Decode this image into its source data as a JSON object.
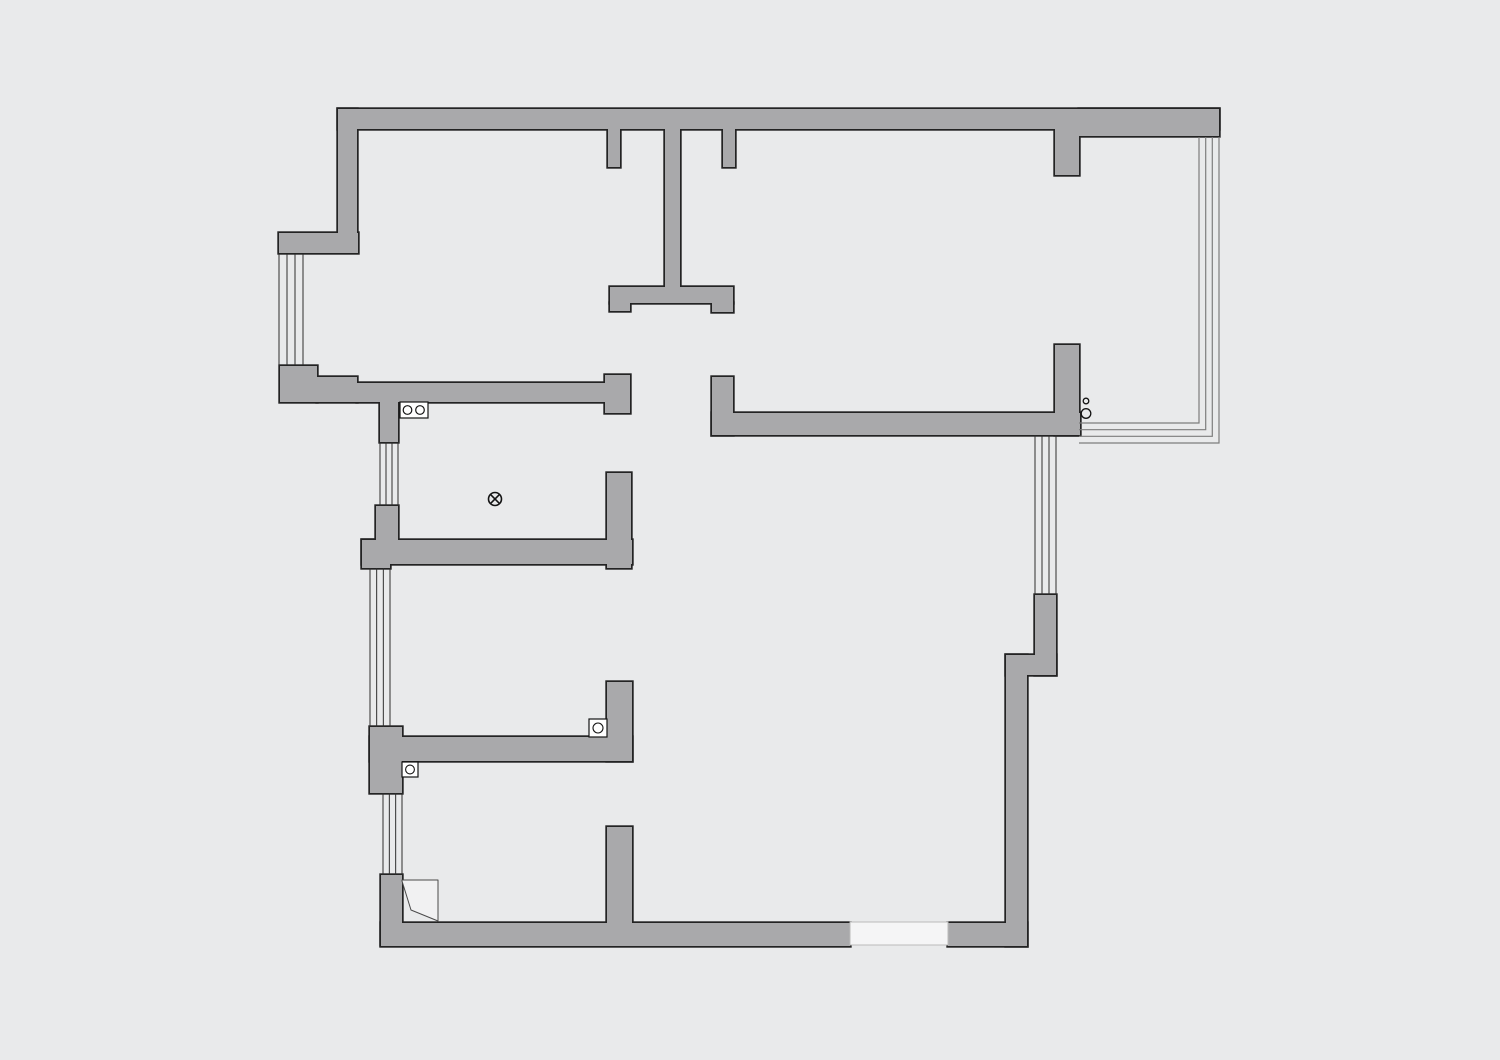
{
  "canvas": {
    "width": 1500,
    "height": 1060,
    "background": "#e9eaeb"
  },
  "style": {
    "wall_fill": "#a9a9ab",
    "wall_outline": "#232323",
    "outline_inflate": 1.7,
    "window_stroke": "#2e2e2e",
    "window_stroke_width": 1,
    "balcony_stroke": "#7d7d7d",
    "balcony_stroke_width": 1.2,
    "symbol_stroke": "#141414",
    "symbol_fill": "#ffffff",
    "opening_fill": "#f5f5f6",
    "opening_stroke": "#bbbbbb",
    "door_stroke": "#4a4a4a",
    "door_fill": "#f1f1f2"
  },
  "walls": [
    {
      "name": "top-wall",
      "x": 338,
      "y": 109,
      "w": 881,
      "h": 20
    },
    {
      "name": "top-wall-right",
      "x": 1079,
      "y": 109,
      "w": 140,
      "h": 27
    },
    {
      "name": "upper-left-wall",
      "x": 338,
      "y": 109,
      "w": 19,
      "h": 124
    },
    {
      "name": "left-jut-block",
      "x": 279,
      "y": 233,
      "w": 79,
      "h": 20
    },
    {
      "name": "top-stub-a",
      "x": 608,
      "y": 129,
      "w": 12,
      "h": 38
    },
    {
      "name": "top-stub-b",
      "x": 723,
      "y": 129,
      "w": 12,
      "h": 38
    },
    {
      "name": "top-stub-c",
      "x": 1055,
      "y": 129,
      "w": 24,
      "h": 46
    },
    {
      "name": "hall-wall-vertical",
      "x": 665,
      "y": 129,
      "w": 15,
      "h": 159
    },
    {
      "name": "hall-t-bar",
      "x": 610,
      "y": 287,
      "w": 123,
      "h": 16
    },
    {
      "name": "hall-t-foot-left",
      "x": 610,
      "y": 303,
      "w": 20,
      "h": 8
    },
    {
      "name": "hall-t-foot-right",
      "x": 712,
      "y": 303,
      "w": 21,
      "h": 9
    },
    {
      "name": "kitchen-left-block",
      "x": 280,
      "y": 366,
      "w": 37,
      "h": 36
    },
    {
      "name": "kitchen-step",
      "x": 317,
      "y": 377,
      "w": 40,
      "h": 25
    },
    {
      "name": "kitchen-north-wall",
      "x": 357,
      "y": 383,
      "w": 248,
      "h": 19
    },
    {
      "name": "kitchen-ne-block",
      "x": 605,
      "y": 375,
      "w": 25,
      "h": 38
    },
    {
      "name": "kitchen-west-stub",
      "x": 380,
      "y": 402,
      "w": 18,
      "h": 40
    },
    {
      "name": "kitchen-sw-block",
      "x": 376,
      "y": 506,
      "w": 22,
      "h": 35
    },
    {
      "name": "mid-bar",
      "x": 362,
      "y": 540,
      "w": 270,
      "h": 24
    },
    {
      "name": "mid-bar-left-block",
      "x": 362,
      "y": 540,
      "w": 28,
      "h": 28
    },
    {
      "name": "mid-east-wall",
      "x": 607,
      "y": 473,
      "w": 24,
      "h": 95
    },
    {
      "name": "living-stub",
      "x": 712,
      "y": 377,
      "w": 21,
      "h": 58
    },
    {
      "name": "living-bar",
      "x": 712,
      "y": 413,
      "w": 368,
      "h": 22
    },
    {
      "name": "balcony-wall",
      "x": 1055,
      "y": 345,
      "w": 24,
      "h": 90
    },
    {
      "name": "lower-bar",
      "x": 370,
      "y": 737,
      "w": 262,
      "h": 24
    },
    {
      "name": "lower-left-block",
      "x": 370,
      "y": 727,
      "w": 32,
      "h": 66
    },
    {
      "name": "lower-stub-up",
      "x": 607,
      "y": 682,
      "w": 25,
      "h": 79
    },
    {
      "name": "bottom-left-block",
      "x": 381,
      "y": 875,
      "w": 21,
      "h": 70
    },
    {
      "name": "bottom-wall",
      "x": 381,
      "y": 923,
      "w": 469,
      "h": 23
    },
    {
      "name": "bottom-wall-right",
      "x": 948,
      "y": 923,
      "w": 79,
      "h": 23
    },
    {
      "name": "bottom-stub",
      "x": 607,
      "y": 827,
      "w": 25,
      "h": 96
    },
    {
      "name": "right-wall",
      "x": 1006,
      "y": 655,
      "w": 21,
      "h": 291
    },
    {
      "name": "right-jog",
      "x": 1006,
      "y": 655,
      "w": 50,
      "h": 20
    },
    {
      "name": "right-window-block",
      "x": 1035,
      "y": 595,
      "w": 21,
      "h": 80
    }
  ],
  "windows": [
    {
      "name": "window-left-top",
      "x1": 279,
      "x2": 303,
      "y1": 254,
      "y2": 365,
      "lines": 4
    },
    {
      "name": "window-kitchen",
      "x1": 380,
      "x2": 398,
      "y1": 442,
      "y2": 506,
      "lines": 4
    },
    {
      "name": "window-left-middle",
      "x1": 370,
      "x2": 390,
      "y1": 568,
      "y2": 727,
      "lines": 4
    },
    {
      "name": "window-left-bottom",
      "x1": 383,
      "x2": 402,
      "y1": 793,
      "y2": 875,
      "lines": 4
    },
    {
      "name": "window-right",
      "x1": 1035,
      "x2": 1056,
      "y1": 435,
      "y2": 595,
      "lines": 4
    }
  ],
  "balcony_window": {
    "name": "balcony-window",
    "y_top": 137,
    "x_end": 1079,
    "lines": [
      {
        "x": 1219,
        "y_corner": 443
      },
      {
        "x": 1212.3,
        "y_corner": 436.3
      },
      {
        "x": 1205.7,
        "y_corner": 429.7
      },
      {
        "x": 1199,
        "y_corner": 423
      }
    ]
  },
  "opening": {
    "name": "entry-opening",
    "x": 850,
    "y": 922,
    "w": 98,
    "h": 23
  },
  "door": {
    "name": "door-swing",
    "path": "M 402 880 L 438 880 L 438 921 L 411 910 L 402 881 Z"
  },
  "symbols": {
    "stove": {
      "x": 400,
      "y": 402,
      "w": 28,
      "h": 16,
      "burners": [
        {
          "cx": 407.5,
          "cy": 410,
          "r": 4.3
        },
        {
          "cx": 420,
          "cy": 410,
          "r": 4.3
        }
      ]
    },
    "ceiling_fixture": {
      "cx": 495,
      "cy": 499,
      "r": 6.5
    },
    "drains": [
      {
        "x": 402,
        "y": 762,
        "w": 16,
        "h": 15,
        "cx": 410,
        "cy": 769.5,
        "r": 4.4
      },
      {
        "x": 589,
        "y": 719,
        "w": 18,
        "h": 18,
        "cx": 598,
        "cy": 728,
        "r": 5
      }
    ],
    "gas_points": [
      {
        "cx": 1086,
        "cy": 401,
        "r": 2.8
      },
      {
        "cx": 1086,
        "cy": 413.5,
        "r": 4.8
      }
    ]
  }
}
